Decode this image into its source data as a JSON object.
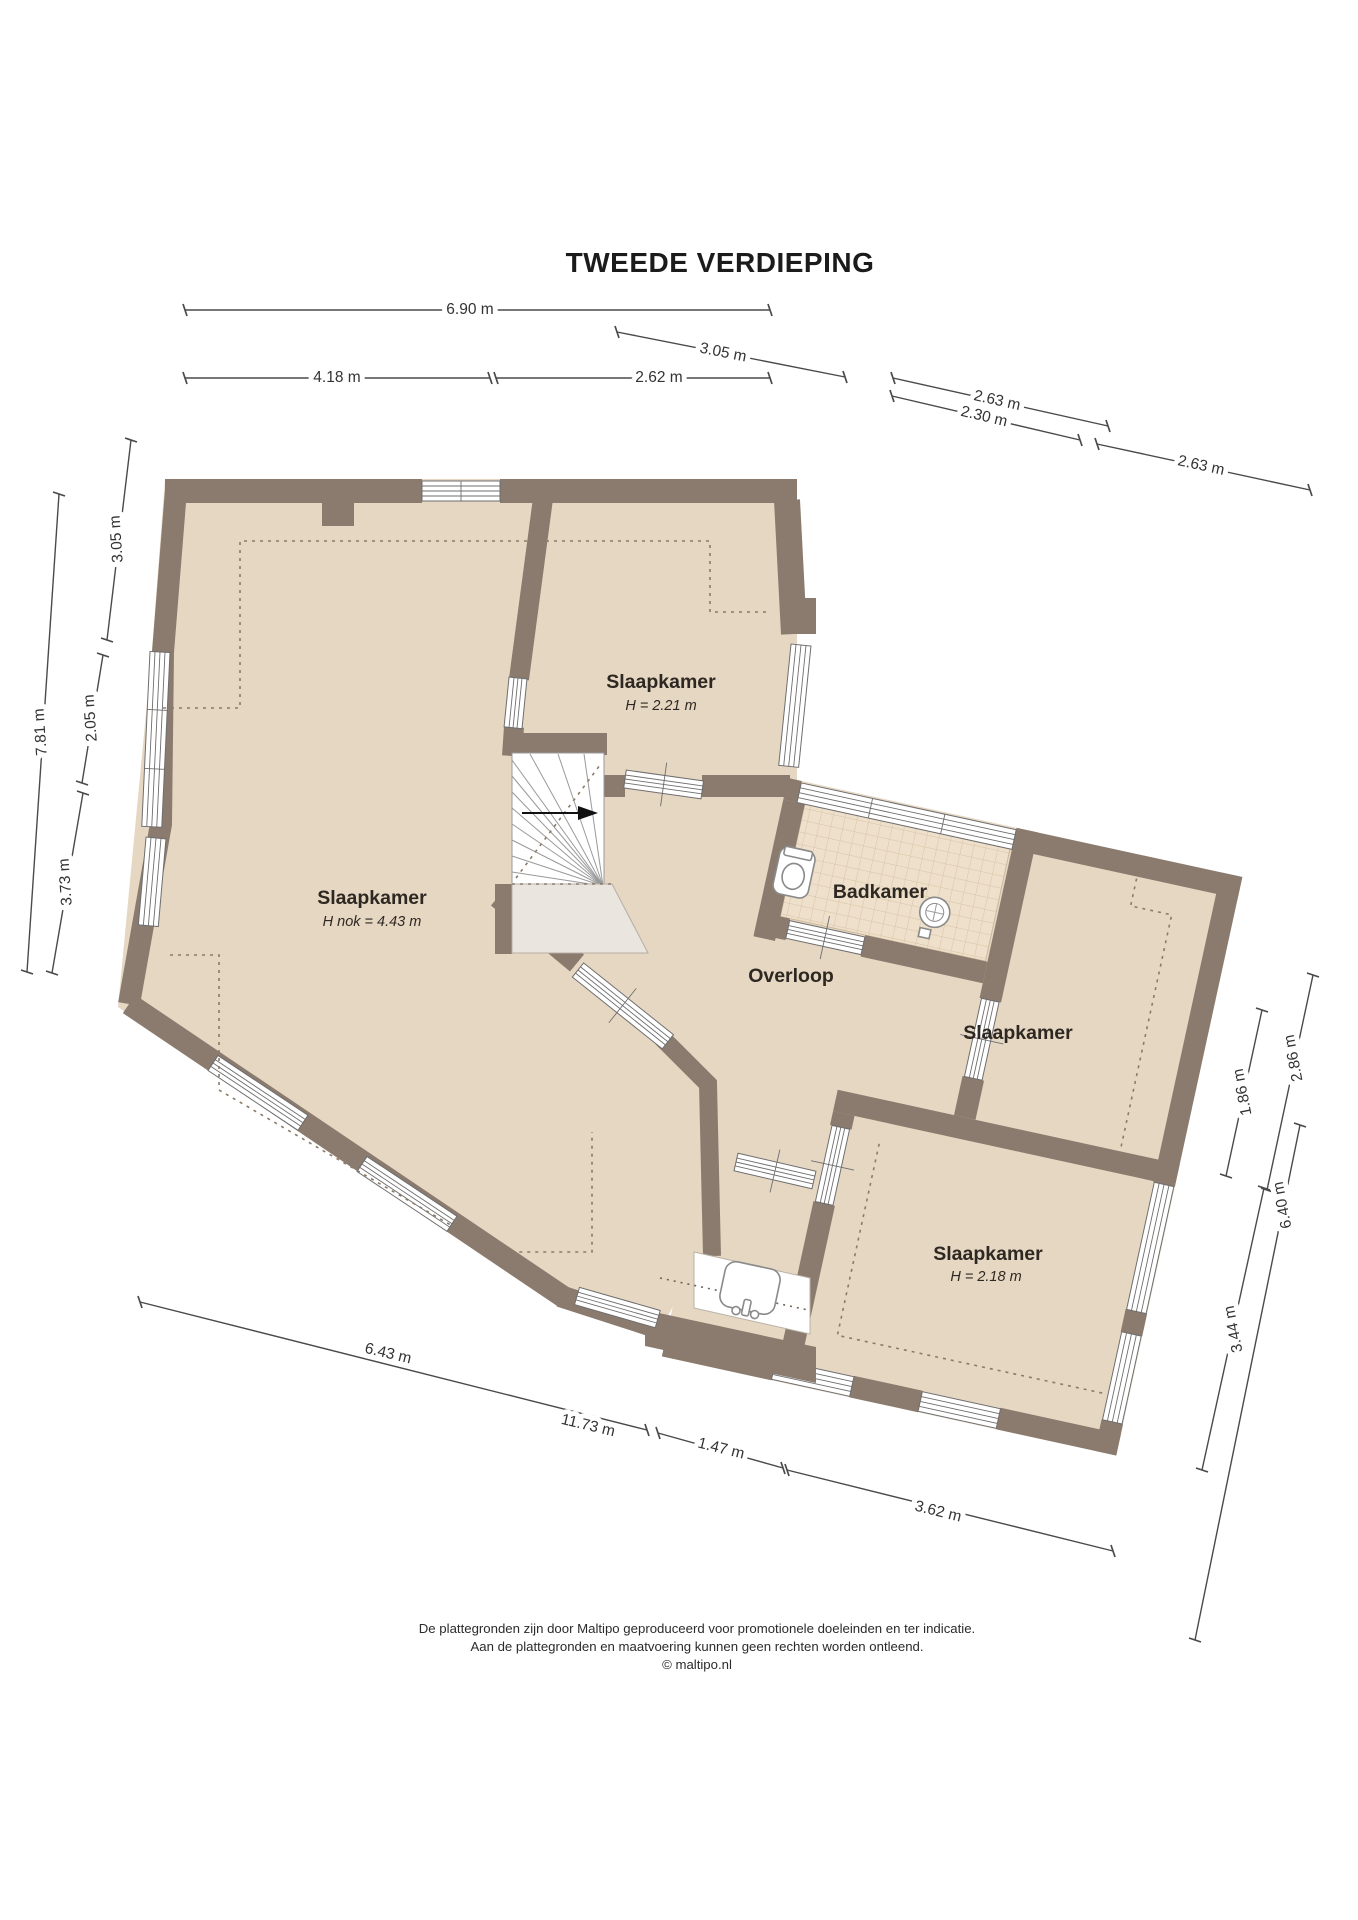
{
  "title": "TWEEDE VERDIEPING",
  "rooms": {
    "bedroom_main": {
      "name": "Slaapkamer",
      "height_note": "H nok = 4.43 m"
    },
    "bedroom_top": {
      "name": "Slaapkamer",
      "height_note": "H = 2.21 m"
    },
    "bathroom": {
      "name": "Badkamer"
    },
    "landing": {
      "name": "Overloop"
    },
    "bedroom_right": {
      "name": "Slaapkamer"
    },
    "bedroom_bottom": {
      "name": "Slaapkamer",
      "height_note": "H = 2.18 m"
    }
  },
  "dimensions": {
    "top": [
      {
        "label": "6.90 m"
      },
      {
        "label": "4.18 m"
      },
      {
        "label": "2.62 m"
      },
      {
        "label": "3.05 m"
      },
      {
        "label": "2.63 m"
      },
      {
        "label": "2.30 m"
      },
      {
        "label": "2.63 m"
      }
    ],
    "left": [
      {
        "label": "3.05 m"
      },
      {
        "label": "7.81 m"
      },
      {
        "label": "2.05 m"
      },
      {
        "label": "3.73 m"
      }
    ],
    "right": [
      {
        "label": "1.86 m"
      },
      {
        "label": "2.86 m"
      },
      {
        "label": "6.40 m"
      },
      {
        "label": "3.44 m"
      }
    ],
    "bottom": [
      {
        "label": "6.43 m"
      },
      {
        "label": "11.73 m"
      },
      {
        "label": "1.47 m"
      },
      {
        "label": "3.62 m"
      }
    ]
  },
  "footer": {
    "line1": "De plattegronden zijn door Maltipo geproduceerd voor promotionele doeleinden en ter indicatie.",
    "line2": "Aan de plattegronden en maatvoering kunnen geen rechten worden ontleend.",
    "line3": "© maltipo.nl"
  },
  "colors": {
    "wall": "#8a7b6e",
    "floor": "#e6d7c3",
    "bathroom_tile": "#eee0cb",
    "tile_grid": "#d8c3a6",
    "stairwell_void": "#eae6df",
    "dimension_line": "#4a4a4a",
    "text": "#2e2822"
  }
}
